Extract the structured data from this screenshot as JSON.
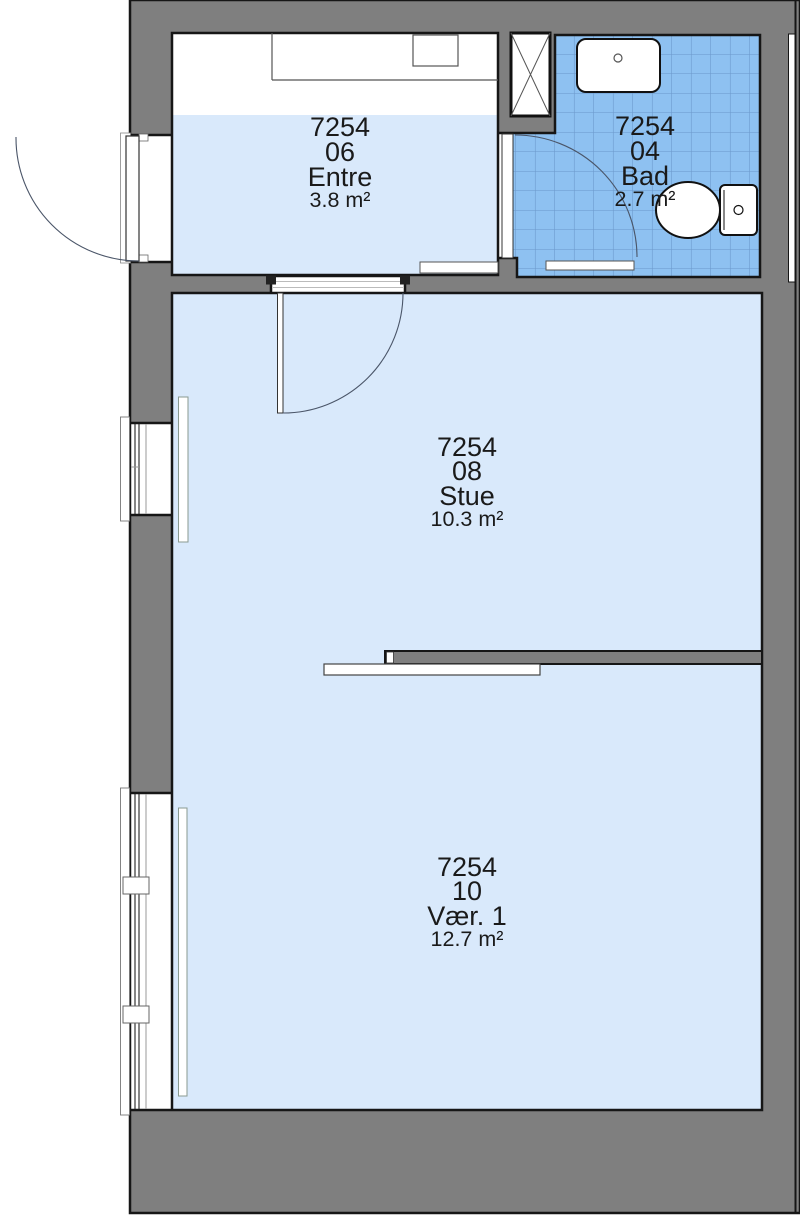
{
  "title": "Floor plan",
  "colors": {
    "wall": "#7f7f7f",
    "outline": "#161616",
    "floor": "#d9e9fb",
    "bath_tile": "#8ec1f1",
    "bath_tile_line": "#6b98cb"
  },
  "rooms": [
    {
      "key": "entre",
      "number": "7254",
      "id": "06",
      "name": "Entre",
      "area": "3.8 m²"
    },
    {
      "key": "bad",
      "number": "7254",
      "id": "04",
      "name": "Bad",
      "area": "2.7 m²"
    },
    {
      "key": "stue",
      "number": "7254",
      "id": "08",
      "name": "Stue",
      "area": "10.3 m²"
    },
    {
      "key": "vaer1",
      "number": "7254",
      "id": "10",
      "name": "Vær. 1",
      "area": "12.7 m²"
    }
  ]
}
